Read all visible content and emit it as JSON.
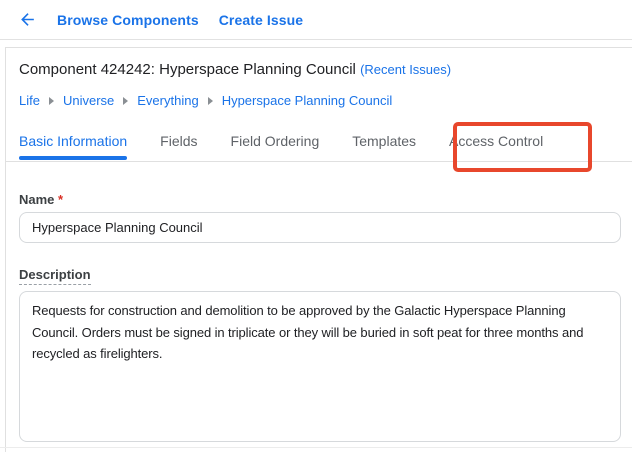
{
  "toolbar": {
    "back_icon": "arrow-back-icon",
    "browse_components_label": "Browse Components",
    "create_issue_label": "Create Issue"
  },
  "header": {
    "title": "Component 424242: Hyperspace Planning Council",
    "recent_issues_label": "(Recent Issues)"
  },
  "breadcrumb": {
    "separator_icon": "chevron-right-icon",
    "items": [
      "Life",
      "Universe",
      "Everything",
      "Hyperspace Planning Council"
    ]
  },
  "tabs": [
    {
      "label": "Basic Information",
      "active": true,
      "highlighted": false
    },
    {
      "label": "Fields",
      "active": false,
      "highlighted": false
    },
    {
      "label": "Field Ordering",
      "active": false,
      "highlighted": false
    },
    {
      "label": "Templates",
      "active": false,
      "highlighted": false
    },
    {
      "label": "Access Control",
      "active": false,
      "highlighted": true
    }
  ],
  "form": {
    "name": {
      "label": "Name",
      "required_marker": "*",
      "value": "Hyperspace Planning Council"
    },
    "description": {
      "label": "Description",
      "value": "Requests for construction and demolition to be approved by the Galactic Hyperspace Planning Council. Orders must be signed in triplicate or they will be buried in soft peat for three months and recycled as firelighters."
    }
  },
  "colors": {
    "link_blue": "#1a73e8",
    "active_tab_blue": "#1a73e8",
    "inactive_tab_gray": "#5f6368",
    "annotation_red": "#e8472c",
    "required_red": "#d93025",
    "text_dark": "#202124",
    "label_gray": "#3c4043",
    "divider_gray": "#e0e0e0",
    "input_border_gray": "#d6d9dc"
  }
}
